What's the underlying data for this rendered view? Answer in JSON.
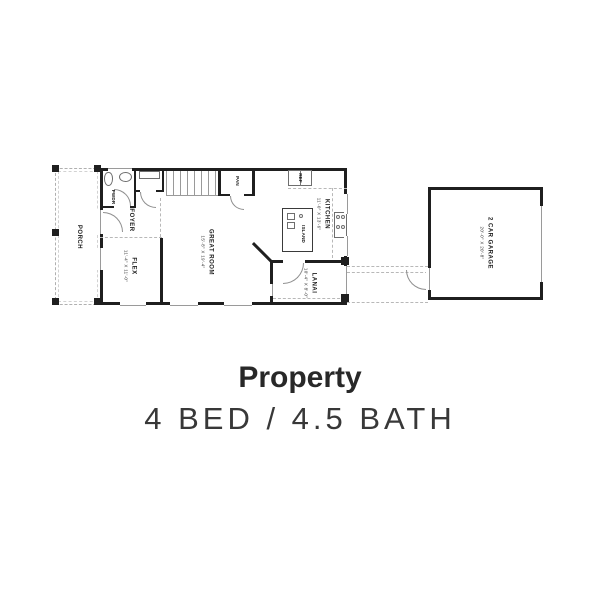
{
  "colors": {
    "wall": "#1f1f1f",
    "dashed_line": "#b8b8b8",
    "door_arc": "#8f8f8f",
    "label_text": "#1d1d1d",
    "title_text": "#282828",
    "subtitle_text": "#383838"
  },
  "floorplan": {
    "rooms": {
      "porch": {
        "label": "PORCH"
      },
      "pwdr": {
        "label": "PWDR"
      },
      "foyer": {
        "label": "FOYER"
      },
      "flex": {
        "label": "FLEX",
        "dims": "11'-4\" X 11'-0\""
      },
      "great_room": {
        "label": "GREAT ROOM",
        "dims": "15'-8\" X 19'-4\""
      },
      "pantry": {
        "label": "PAN"
      },
      "kitchen": {
        "label": "KITCHEN",
        "dims": "11'-0\" X 13'-6\""
      },
      "fridge": {
        "label": "REF"
      },
      "island": {
        "label": "ISLAND"
      },
      "lanai": {
        "label": "LANAI",
        "dims": "10'-4\" X 8'-0\""
      },
      "garage": {
        "label": "2 CAR GARAGE",
        "dims": "20'-0\" X 20'-8\""
      }
    }
  },
  "caption": {
    "title": "Property",
    "subtitle": "4 BED / 4.5 BATH"
  }
}
